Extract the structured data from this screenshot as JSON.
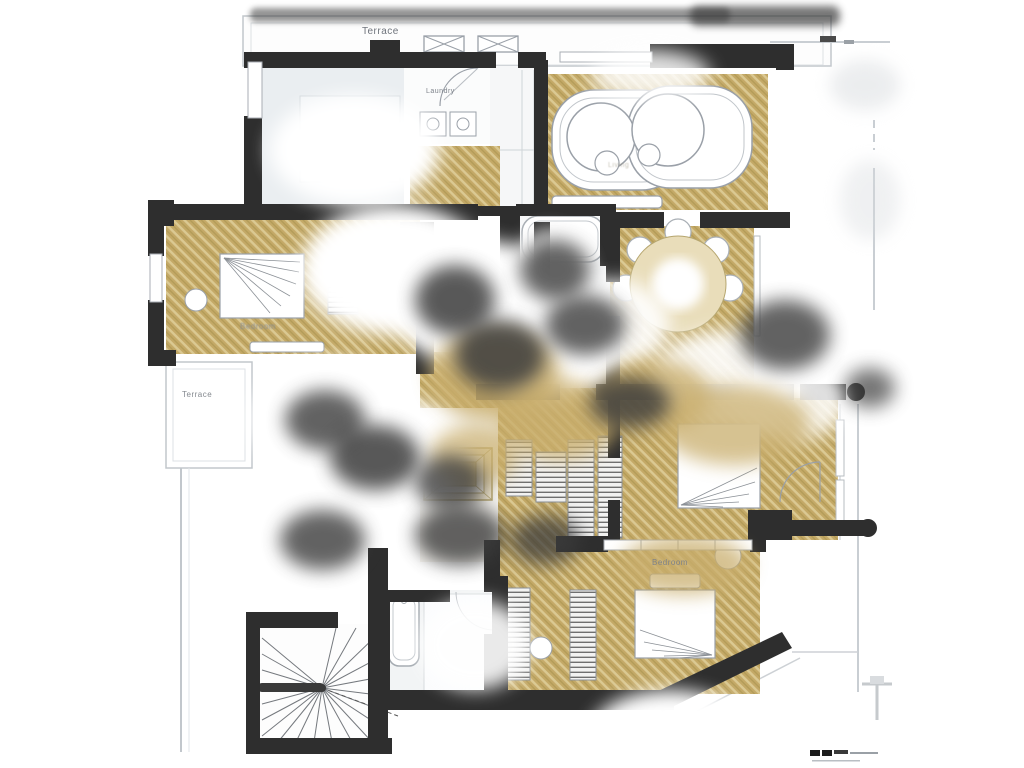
{
  "document": {
    "type": "architectural floor plan"
  },
  "labels": {
    "terrace_top": "Terrace",
    "laundry": "Laundry",
    "bedroom_left": "Bedroom",
    "terrace_left": "Terrace",
    "living_room": "Living",
    "bedroom_bottom": "Bedroom"
  },
  "colors": {
    "wall": "#2e2e2e",
    "floor_gold": "#c4a967",
    "floor_gold_light": "#dbc992",
    "furniture_outline": "#9aa0a8",
    "terrace_outline": "#c2c7cc",
    "label_text": "#7d828a"
  },
  "scale_bar": {
    "present": true
  }
}
